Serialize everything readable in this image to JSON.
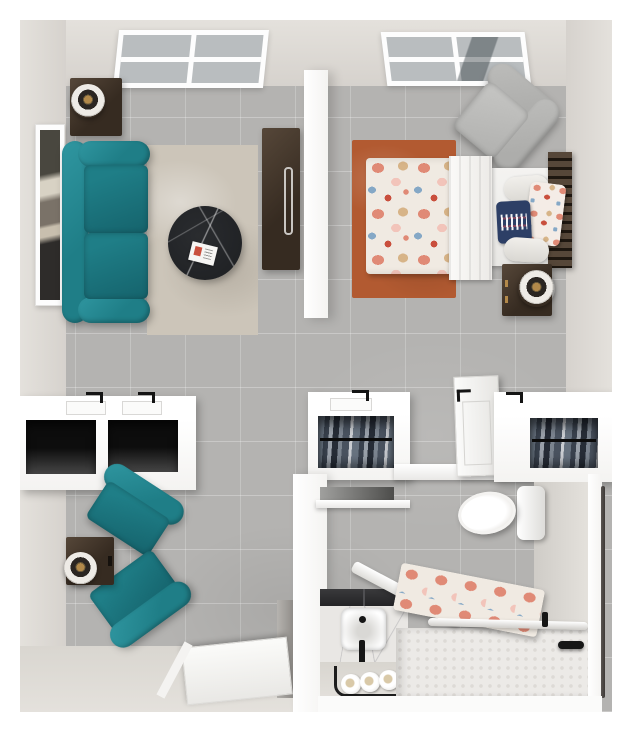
{
  "scene": {
    "kind": "3d-top-down-floor-plan-render",
    "rooms": [
      {
        "id": "living-room",
        "items": [
          "window",
          "table-lamp",
          "dark-side-table",
          "framed-wall-art",
          "teal-sofa",
          "distressed-area-rug",
          "round-black-marble-coffee-table",
          "magazine",
          "tall-dark-cabinet"
        ]
      },
      {
        "id": "bedroom",
        "items": [
          "window",
          "gray-armchair",
          "rust-area-rug",
          "bed-with-floral-comforter",
          "white-throw-blanket",
          "white-bolster-pillows",
          "navy-accent-pillow",
          "floral-accent-pillow",
          "dark-slat-headboard",
          "dark-nightstand",
          "ring-table-lamp"
        ]
      },
      {
        "id": "kitchenette-nook",
        "items": [
          "white-counter-unit",
          "two-open-cabinet-bays",
          "black-pull-handles",
          "paper-trays"
        ]
      },
      {
        "id": "hallway-closets",
        "items": [
          "closet-with-hanging-clothes",
          "open-white-bathroom-door",
          "second-closet-with-hanging-clothes"
        ]
      },
      {
        "id": "den",
        "items": [
          "teal-armchair",
          "teal-armchair",
          "dark-side-table",
          "ring-table-lamp",
          "open-entry-door"
        ]
      },
      {
        "id": "bathroom",
        "items": [
          "toilet",
          "mirror-strip",
          "white-shelf",
          "dark-vanity-counter",
          "marble-vanity-front",
          "square-sink",
          "black-faucet",
          "towel-rack-with-rolled-towels",
          "floral-shower-curtain",
          "roll-in-shower",
          "shower-rod",
          "black-grab-bar",
          "vertical-grab-rail"
        ]
      }
    ]
  },
  "palette": {
    "page-bg": "#ffffff",
    "wall-warm": "#d6d2cd",
    "wall-warm-2": "#e4e1dc",
    "wall-white": "#f4f3f1",
    "floor-tile": "#b4b3b1",
    "grout": "#c6c5c3",
    "teal": "#1f7e87",
    "teal-deep": "#15636c",
    "teal-light": "#2f96a0",
    "wood": "#362b21",
    "wood-light": "#564739",
    "rug-living": "#ccc5b9",
    "rug-rust": "#b25a31",
    "marble-dark": "#212326",
    "chair-gray": "#adadab",
    "linen": "#f2f1ee",
    "navy": "#2d3f66",
    "coral": "#e08a76",
    "coral-light": "#f2c4ba",
    "blue-floral": "#85a8c6",
    "tan-floral": "#d7b488",
    "red-floral": "#c94f3d",
    "gold": "#b2894a",
    "fixture-black": "#161616",
    "curtain-base": "#f0eae2",
    "glass": "#b9bdbf",
    "silver": "#c9c6c2"
  }
}
